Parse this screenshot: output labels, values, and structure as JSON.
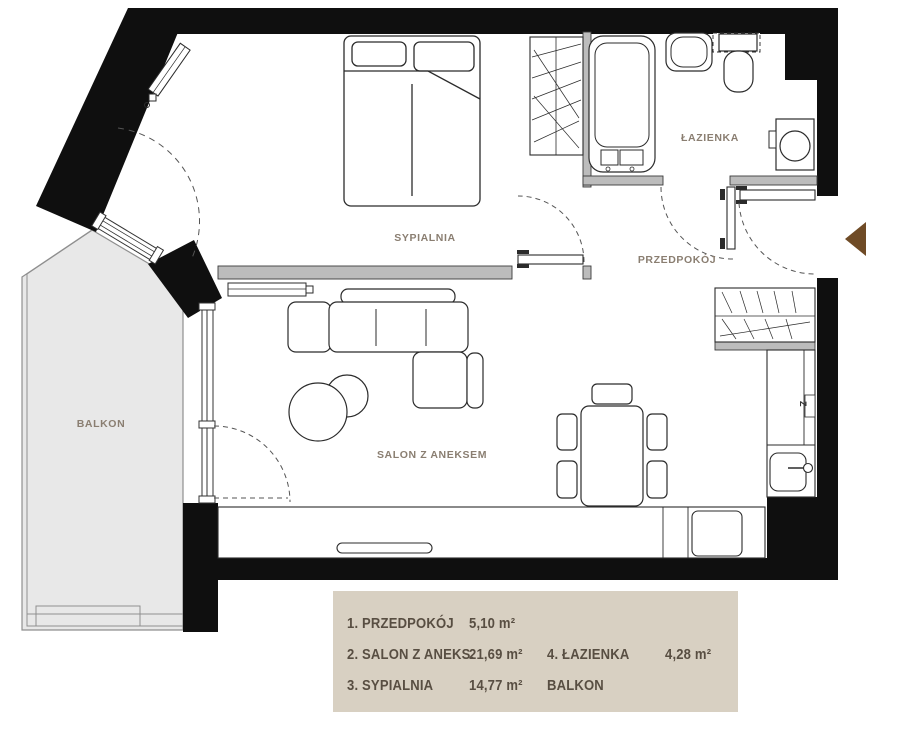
{
  "plan": {
    "rooms": [
      {
        "id": "sypialnia",
        "label": "SYPIALNIA"
      },
      {
        "id": "lazienka",
        "label": "ŁAZIENKA"
      },
      {
        "id": "przedpokoj",
        "label": "PRZEDPOKÓJ"
      },
      {
        "id": "salon",
        "label": "SALON Z ANEKSEM"
      },
      {
        "id": "balkon",
        "label": "BALKON"
      }
    ],
    "appliance_marks": {
      "dishwasher": "Z"
    }
  },
  "legend": {
    "rows": [
      {
        "l": "1. PRZEDPOKÓJ",
        "la": "5,10 m²",
        "r": "",
        "ra": ""
      },
      {
        "l": "2. SALON Z ANEKS.",
        "la": "21,69 m²",
        "r": "4. ŁAZIENKA",
        "ra": "4,28 m²"
      },
      {
        "l": "3. SYPIALNIA",
        "la": "14,77 m²",
        "r": "BALKON",
        "ra": ""
      }
    ]
  },
  "colors": {
    "exterior_wall": "#0f0f0f",
    "interior_wall": "#bcbcbc",
    "balcony_floor": "#e8e8e8",
    "legend_bg": "#d8d0c2",
    "legend_text": "#584e42",
    "room_label": "#8a7e71",
    "entrance_arrow": "#6f4b26"
  }
}
